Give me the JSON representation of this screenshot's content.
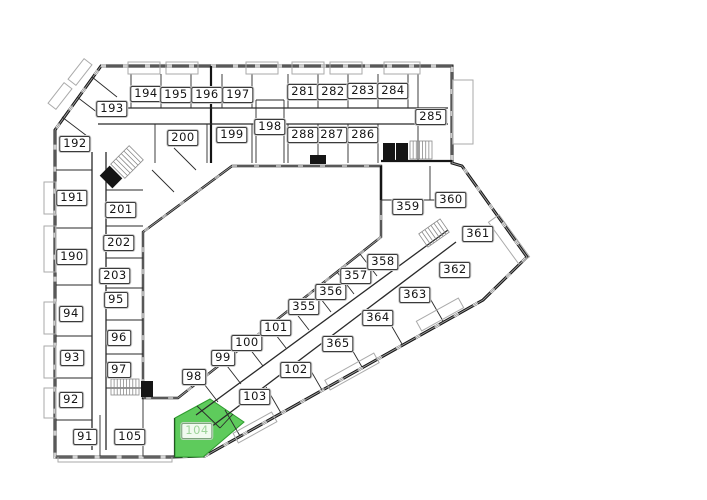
{
  "colors": {
    "wall": "#151515",
    "thin": "#9a9a9a",
    "partition": "#2a2a2a",
    "balcony": "#aaaaaa",
    "stair": "#8a8a8a",
    "green_fill": "#5ecb5c",
    "green_edge": "#2f9c2f",
    "green_inner": "#2a2a2a",
    "label_bg": "#ffffff",
    "label_border": "#3a3a3a",
    "label_text": "#141414",
    "highlight_label_text": "#9ed49a"
  },
  "highlight": {
    "unit": "104",
    "polygon": "175,418 210,399 244,422 203,457 175,457",
    "inner_lines": [
      [
        197,
        406,
        220,
        428
      ],
      [
        220,
        428,
        233,
        414
      ]
    ]
  },
  "units": [
    {
      "id": "91",
      "x": 85,
      "y": 437
    },
    {
      "id": "92",
      "x": 71,
      "y": 400
    },
    {
      "id": "93",
      "x": 72,
      "y": 358
    },
    {
      "id": "94",
      "x": 71,
      "y": 314
    },
    {
      "id": "95",
      "x": 116,
      "y": 300
    },
    {
      "id": "96",
      "x": 119,
      "y": 338
    },
    {
      "id": "97",
      "x": 119,
      "y": 370
    },
    {
      "id": "98",
      "x": 194,
      "y": 377
    },
    {
      "id": "99",
      "x": 223,
      "y": 358
    },
    {
      "id": "100",
      "x": 247,
      "y": 343
    },
    {
      "id": "101",
      "x": 276,
      "y": 328
    },
    {
      "id": "102",
      "x": 296,
      "y": 370
    },
    {
      "id": "103",
      "x": 255,
      "y": 397
    },
    {
      "id": "104",
      "x": 197,
      "y": 431,
      "highlighted": true
    },
    {
      "id": "105",
      "x": 130,
      "y": 437
    },
    {
      "id": "190",
      "x": 72,
      "y": 257
    },
    {
      "id": "191",
      "x": 72,
      "y": 198
    },
    {
      "id": "192",
      "x": 75,
      "y": 144
    },
    {
      "id": "193",
      "x": 112,
      "y": 109
    },
    {
      "id": "194",
      "x": 146,
      "y": 94
    },
    {
      "id": "195",
      "x": 176,
      "y": 95
    },
    {
      "id": "196",
      "x": 207,
      "y": 95
    },
    {
      "id": "197",
      "x": 238,
      "y": 95
    },
    {
      "id": "198",
      "x": 270,
      "y": 127
    },
    {
      "id": "199",
      "x": 232,
      "y": 135
    },
    {
      "id": "200",
      "x": 183,
      "y": 138
    },
    {
      "id": "201",
      "x": 121,
      "y": 210
    },
    {
      "id": "202",
      "x": 119,
      "y": 243
    },
    {
      "id": "203",
      "x": 115,
      "y": 276
    },
    {
      "id": "281",
      "x": 303,
      "y": 92
    },
    {
      "id": "282",
      "x": 333,
      "y": 92
    },
    {
      "id": "283",
      "x": 363,
      "y": 91
    },
    {
      "id": "284",
      "x": 393,
      "y": 91
    },
    {
      "id": "285",
      "x": 431,
      "y": 117
    },
    {
      "id": "286",
      "x": 363,
      "y": 135
    },
    {
      "id": "287",
      "x": 332,
      "y": 135
    },
    {
      "id": "288",
      "x": 303,
      "y": 135
    },
    {
      "id": "355",
      "x": 304,
      "y": 307
    },
    {
      "id": "356",
      "x": 331,
      "y": 292
    },
    {
      "id": "357",
      "x": 356,
      "y": 276
    },
    {
      "id": "358",
      "x": 383,
      "y": 262
    },
    {
      "id": "359",
      "x": 408,
      "y": 207
    },
    {
      "id": "360",
      "x": 451,
      "y": 200
    },
    {
      "id": "361",
      "x": 478,
      "y": 234
    },
    {
      "id": "362",
      "x": 455,
      "y": 270
    },
    {
      "id": "363",
      "x": 415,
      "y": 295
    },
    {
      "id": "364",
      "x": 378,
      "y": 318
    },
    {
      "id": "365",
      "x": 338,
      "y": 344
    }
  ],
  "floorplan": {
    "outer": "M101,66 L452,66 L452,163 L462,166 L527,257 L483,300 L205,456 L172,457 L55,457 L55,130 Z",
    "courtyard": "M232,166 L381,166 L381,237 L178,398 L143,398 L143,232 Z",
    "thick": [
      [
        211,
        66,
        211,
        163
      ],
      [
        381,
        161,
        452,
        161
      ],
      [
        175,
        418,
        175,
        457
      ],
      [
        381,
        166,
        381,
        200
      ]
    ],
    "corridors": [
      [
        98,
        108,
        448,
        108
      ],
      [
        98,
        124,
        448,
        124
      ],
      [
        92,
        152,
        92,
        450
      ],
      [
        106,
        152,
        106,
        450
      ],
      [
        196,
        415,
        448,
        230
      ],
      [
        207,
        430,
        456,
        242
      ]
    ],
    "partitions": [
      [
        131,
        74,
        131,
        108
      ],
      [
        161,
        74,
        161,
        108
      ],
      [
        191,
        74,
        191,
        108
      ],
      [
        222,
        74,
        222,
        108
      ],
      [
        252,
        74,
        252,
        108
      ],
      [
        288,
        74,
        288,
        108
      ],
      [
        318,
        74,
        318,
        108
      ],
      [
        348,
        74,
        348,
        108
      ],
      [
        378,
        74,
        378,
        108
      ],
      [
        408,
        74,
        408,
        108
      ],
      [
        418,
        74,
        418,
        160
      ],
      [
        155,
        124,
        155,
        163
      ],
      [
        207,
        124,
        207,
        163
      ],
      [
        252,
        124,
        252,
        163
      ],
      [
        288,
        124,
        288,
        163
      ],
      [
        318,
        124,
        318,
        163
      ],
      [
        348,
        124,
        348,
        163
      ],
      [
        378,
        124,
        378,
        163
      ],
      [
        256,
        100,
        256,
        163
      ],
      [
        284,
        100,
        284,
        163
      ],
      [
        256,
        100,
        284,
        100
      ],
      [
        56,
        170,
        92,
        170
      ],
      [
        56,
        228,
        92,
        228
      ],
      [
        56,
        285,
        92,
        285
      ],
      [
        56,
        336,
        92,
        336
      ],
      [
        56,
        378,
        92,
        378
      ],
      [
        56,
        420,
        92,
        420
      ],
      [
        106,
        190,
        143,
        190
      ],
      [
        106,
        226,
        143,
        226
      ],
      [
        106,
        258,
        143,
        258
      ],
      [
        106,
        288,
        143,
        288
      ],
      [
        106,
        320,
        143,
        320
      ],
      [
        106,
        354,
        143,
        354
      ],
      [
        106,
        388,
        143,
        388
      ],
      [
        100,
        415,
        100,
        457
      ],
      [
        143,
        398,
        143,
        457
      ],
      [
        201,
        380,
        218,
        402
      ],
      [
        224,
        362,
        241,
        384
      ],
      [
        246,
        344,
        263,
        366
      ],
      [
        269,
        326,
        286,
        348
      ],
      [
        292,
        308,
        309,
        330
      ],
      [
        314,
        290,
        331,
        312
      ],
      [
        337,
        272,
        354,
        294
      ],
      [
        360,
        254,
        377,
        276
      ],
      [
        240,
        436,
        225,
        410
      ],
      [
        281,
        413,
        266,
        387
      ],
      [
        322,
        390,
        307,
        364
      ],
      [
        362,
        367,
        347,
        341
      ],
      [
        402,
        344,
        387,
        318
      ],
      [
        443,
        321,
        428,
        295
      ],
      [
        430,
        166,
        430,
        200
      ],
      [
        381,
        200,
        445,
        200
      ],
      [
        62,
        117,
        87,
        136
      ],
      [
        77,
        97,
        102,
        116
      ],
      [
        92,
        77,
        117,
        97
      ],
      [
        152,
        170,
        174,
        192
      ],
      [
        174,
        148,
        196,
        170
      ]
    ],
    "balconies": [
      [
        128,
        62,
        32,
        12,
        0
      ],
      [
        166,
        62,
        32,
        12,
        0
      ],
      [
        246,
        62,
        32,
        12,
        0
      ],
      [
        292,
        62,
        32,
        12,
        0
      ],
      [
        330,
        62,
        32,
        12,
        0
      ],
      [
        384,
        62,
        36,
        12,
        0
      ],
      [
        453,
        80,
        20,
        64,
        0
      ],
      [
        44,
        182,
        12,
        32,
        0
      ],
      [
        44,
        226,
        12,
        46,
        0
      ],
      [
        44,
        302,
        12,
        32,
        0
      ],
      [
        44,
        346,
        12,
        32,
        0
      ],
      [
        44,
        388,
        12,
        30,
        0
      ],
      [
        58,
        457,
        114,
        5,
        0
      ],
      [
        233,
        422,
        44,
        11,
        -29
      ],
      [
        324,
        366,
        56,
        11,
        -29
      ],
      [
        416,
        309,
        48,
        11,
        -29
      ],
      [
        483,
        233,
        52,
        13,
        54
      ],
      [
        47,
        91,
        26,
        10,
        -52
      ],
      [
        67,
        67,
        26,
        10,
        -52
      ]
    ],
    "stairs": [
      [
        114,
        152,
        26,
        20,
        -45,
        7
      ],
      [
        111,
        379,
        28,
        16,
        0,
        9
      ],
      [
        410,
        141,
        22,
        18,
        0,
        7
      ],
      [
        421,
        225,
        26,
        16,
        -35,
        7
      ]
    ],
    "cores": [
      [
        104,
        168,
        14,
        18,
        -45
      ],
      [
        383,
        143,
        12,
        18,
        0
      ],
      [
        396,
        143,
        12,
        18,
        0
      ],
      [
        141,
        381,
        12,
        16,
        0
      ],
      [
        310,
        155,
        16,
        9,
        0
      ]
    ]
  }
}
